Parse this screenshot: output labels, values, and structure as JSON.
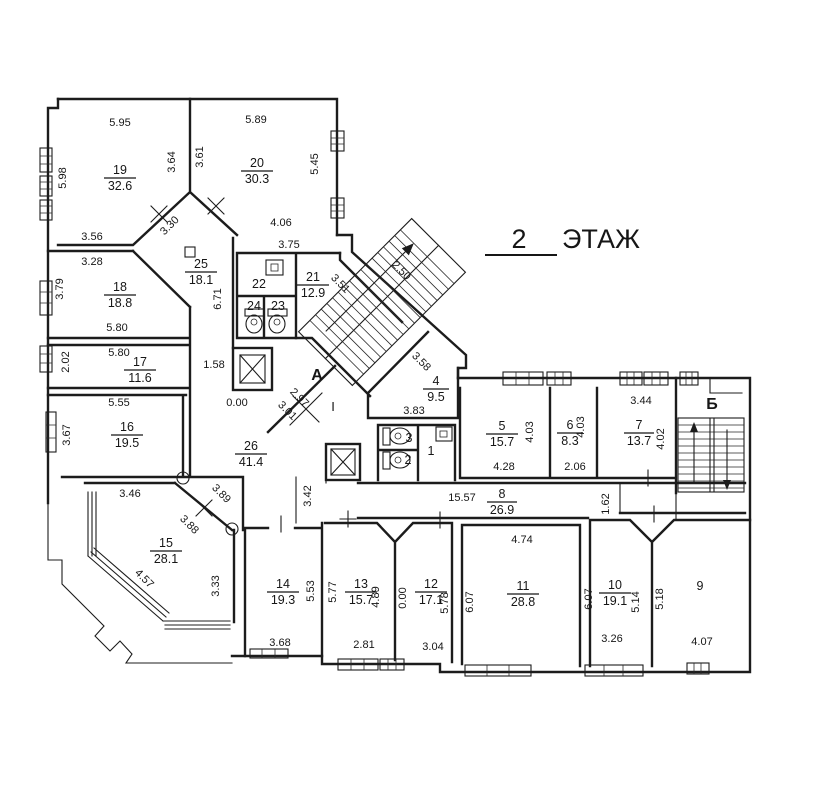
{
  "title": {
    "number": "2",
    "word": "ЭТАЖ"
  },
  "stairs": {
    "a": "А",
    "b": "Б",
    "axis": "I"
  },
  "rooms": [
    {
      "num": "19",
      "area": "32.6"
    },
    {
      "num": "20",
      "area": "30.3"
    },
    {
      "num": "18",
      "area": "18.8"
    },
    {
      "num": "25",
      "area": "18.1"
    },
    {
      "num": "22",
      "area": ""
    },
    {
      "num": "21",
      "area": "12.9"
    },
    {
      "num": "24",
      "area": ""
    },
    {
      "num": "23",
      "area": ""
    },
    {
      "num": "17",
      "area": "11.6"
    },
    {
      "num": "16",
      "area": "19.5"
    },
    {
      "num": "26",
      "area": "41.4"
    },
    {
      "num": "15",
      "area": "28.1"
    },
    {
      "num": "4",
      "area": "9.5"
    },
    {
      "num": "5",
      "area": "15.7"
    },
    {
      "num": "6",
      "area": "8.3"
    },
    {
      "num": "7",
      "area": "13.7"
    },
    {
      "num": "8",
      "area": "26.9"
    },
    {
      "num": "14",
      "area": "19.3"
    },
    {
      "num": "13",
      "area": "15.7"
    },
    {
      "num": "12",
      "area": "17.1"
    },
    {
      "num": "11",
      "area": "28.8"
    },
    {
      "num": "10",
      "area": "19.1"
    },
    {
      "num": "9",
      "area": ""
    },
    {
      "num": "3",
      "area": ""
    },
    {
      "num": "2",
      "area": ""
    },
    {
      "num": "1",
      "area": ""
    }
  ],
  "dims": [
    "5.95",
    "5.89",
    "5.98",
    "3.64",
    "3.61",
    "5.45",
    "3.56",
    "3.30",
    "4.06",
    "3.75",
    "3.28",
    "3.79",
    "5.80",
    "6.71",
    "3.51",
    "2.50",
    "5.80",
    "2.02",
    "1.58",
    "3.58",
    "0.00",
    "2.97",
    "3.01",
    "5.55",
    "3.67",
    "3.83",
    "3.46",
    "3.89",
    "3.88",
    "3.42",
    "4.28",
    "4.03",
    "4.03",
    "2.06",
    "3.44",
    "4.02",
    "15.57",
    "1.62",
    "4.57",
    "3.33",
    "5.53",
    "5.77",
    "4.89",
    "0.00",
    "5.78",
    "6.07",
    "4.74",
    "6.07",
    "5.14",
    "5.18",
    "3.68",
    "2.81",
    "3.04",
    "3.26",
    "4.07"
  ]
}
